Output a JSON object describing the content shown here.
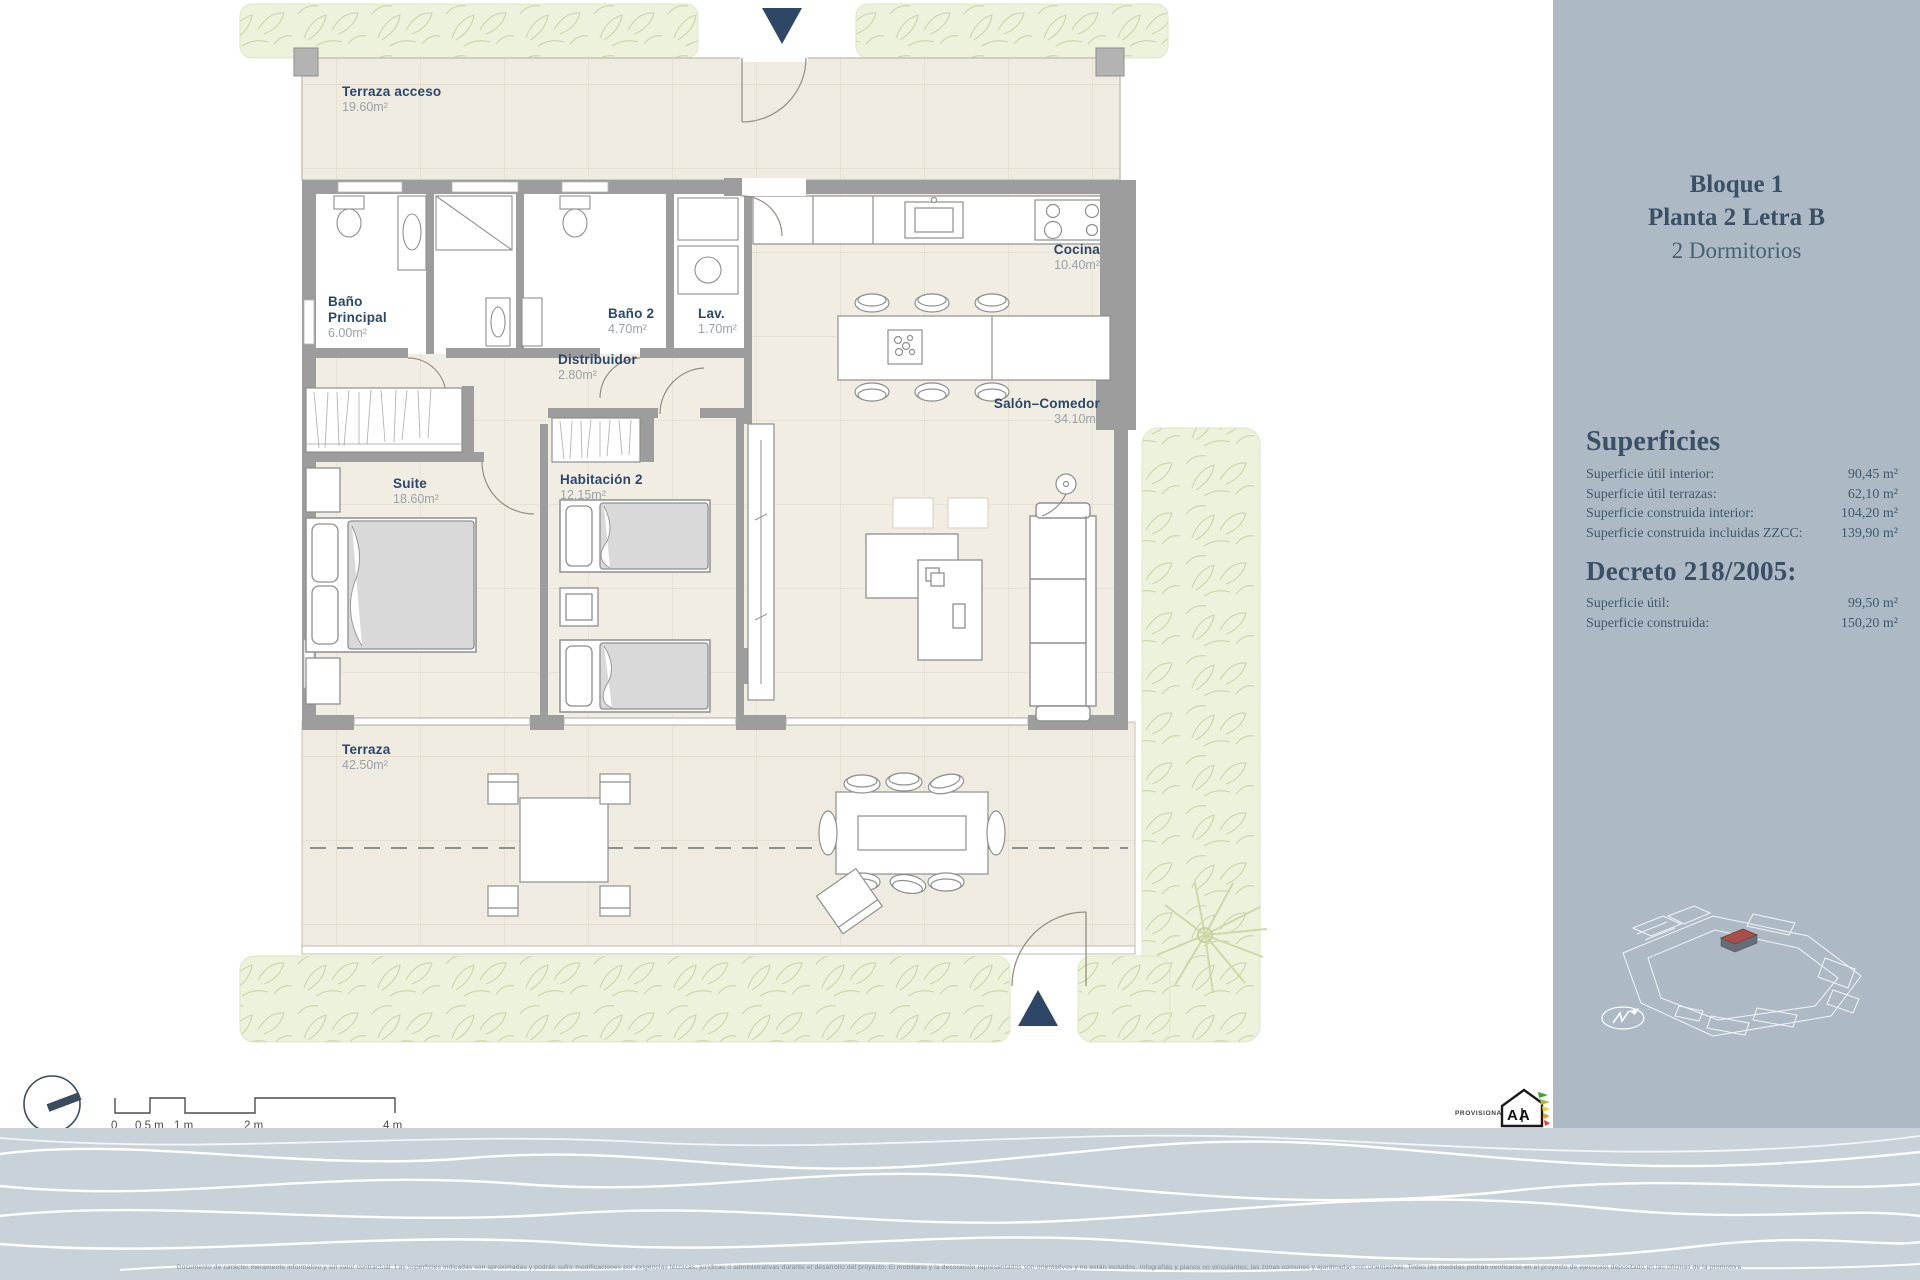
{
  "sidebar": {
    "title_line1": "Bloque 1",
    "title_line2": "Planta 2  Letra B",
    "title_line3": "2 Dormitorios",
    "superficies": {
      "heading": "Superficies",
      "rows": [
        {
          "label": "Superficie útil interior:",
          "value": "90,45 m²"
        },
        {
          "label": "Superficie útil terrazas:",
          "value": "62,10 m²"
        },
        {
          "label": "Superficie construida interior:",
          "value": "104,20 m²"
        },
        {
          "label": "Superficie construida incluidas ZZCC:",
          "value": "139,90 m²"
        }
      ]
    },
    "decreto": {
      "heading": "Decreto 218/2005:",
      "rows": [
        {
          "label": "Superficie útil:",
          "value": "99,50 m²"
        },
        {
          "label": "Superficie construida:",
          "value": "150,20 m²"
        }
      ]
    }
  },
  "plan": {
    "rooms": [
      {
        "name": "Terraza acceso",
        "area": "19.60m²"
      },
      {
        "name": "Baño Principal",
        "area": "6.00m²"
      },
      {
        "name": "Baño 2",
        "area": "4.70m²"
      },
      {
        "name": "Lav.",
        "area": "1.70m²"
      },
      {
        "name": "Distribuidor",
        "area": "2.80m²"
      },
      {
        "name": "Cocina",
        "area": "10.40m²"
      },
      {
        "name": "Salón–Comedor",
        "area": "34.10m²"
      },
      {
        "name": "Suite",
        "area": "18.60m²"
      },
      {
        "name": "Habitación 2",
        "area": "12.15m²"
      },
      {
        "name": "Terraza",
        "area": "42.50m²"
      }
    ]
  },
  "scalebar": {
    "labels": [
      "0",
      "0,5 m",
      "1 m",
      "2 m",
      "4 m"
    ]
  },
  "footer": {
    "provisional": "PROVISIONAL",
    "energy_text": "A A",
    "disclaimer": "Documento de carácter meramente informativo y sin valor contractual. Las superficies indicadas son aproximadas y podrán sufrir modificaciones por exigencias técnicas, jurídicas o administrativas durante el desarrollo del proyecto. El mobiliario y la decoración representados son orientativos y no están incluidos. Infografías y planos no vinculantes; las zonas comunes y ajardinadas son orientativas. Todas las medidas podrán verificarse en el proyecto de ejecución depositado en las oficinas de la promotora."
  },
  "colors": {
    "accent_navy": "#2e4766",
    "sidebar_bg": "#adbac5",
    "floor_beige": "#f2ede3",
    "terrace_beige": "#f0ebe0",
    "hedge_green": "#edf2dd",
    "wall_gray": "#9d9d9d",
    "wave_bg": "#c9d2d8"
  }
}
